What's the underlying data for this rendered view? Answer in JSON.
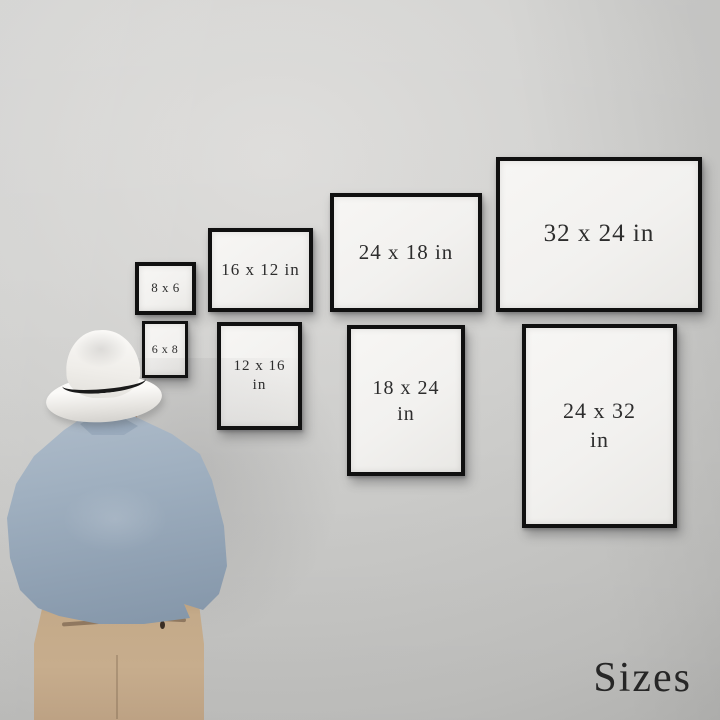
{
  "scene": {
    "caption": "Sizes",
    "description": "man in a white fedora viewed from behind, looking at a gallery wall of framed print-size examples"
  },
  "colors": {
    "wall": "#cccccb",
    "frame_border": "#101010",
    "frame_paper": "#f2f1ef",
    "label_text": "#2d2d2d",
    "hat": "#f5f3f0",
    "hat_band": "#1a1a1a",
    "hair": "#4a362c",
    "shirt": "#9dadbf",
    "pants": "#c4aa89"
  },
  "frames": [
    {
      "name": "frame-8x6",
      "label": "8 x 6",
      "orientation": "landscape"
    },
    {
      "name": "frame-16x12",
      "label": "16 x 12 in",
      "orientation": "landscape"
    },
    {
      "name": "frame-24x18",
      "label": "24 x 18 in",
      "orientation": "landscape"
    },
    {
      "name": "frame-32x24",
      "label": "32 x 24 in",
      "orientation": "landscape"
    },
    {
      "name": "frame-6x8",
      "label": "6 x 8",
      "orientation": "portrait"
    },
    {
      "name": "frame-12x16",
      "label": "12 x 16 in",
      "orientation": "portrait"
    },
    {
      "name": "frame-18x24",
      "label": "18 x 24 in",
      "orientation": "portrait"
    },
    {
      "name": "frame-24x32",
      "label": "24 x 32 in",
      "orientation": "portrait"
    }
  ]
}
